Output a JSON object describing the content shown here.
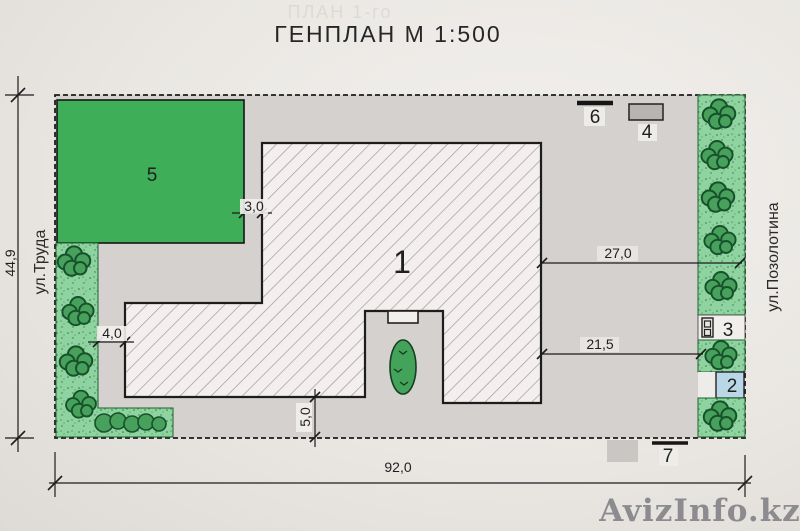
{
  "title": "ГЕНПЛАН М 1:500",
  "ghost_title": "ПЛАН 1-го",
  "watermark": "AvizInfo.kz",
  "streets": {
    "left": "ул.Труда",
    "right": "ул.Позолотина"
  },
  "site": {
    "width_label": "92,0",
    "height_label": "44,9"
  },
  "objects": {
    "n1": "1",
    "n2": "2",
    "n3": "3",
    "n4": "4",
    "n5": "5",
    "n6": "6",
    "n7": "7"
  },
  "dimensions": {
    "d30": "3,0",
    "d40": "4,0",
    "d50": "5,0",
    "d270": "27,0",
    "d215": "21,5"
  },
  "colors": {
    "paving": "#d4d1ce",
    "lawn": "#3eae59",
    "planting_strip": "#8ed3a0",
    "bush": "#47a05c",
    "water": "#b9d7e6",
    "hatch": "#a5928e",
    "line": "#1c1c1c",
    "watermark": "#85858a"
  }
}
